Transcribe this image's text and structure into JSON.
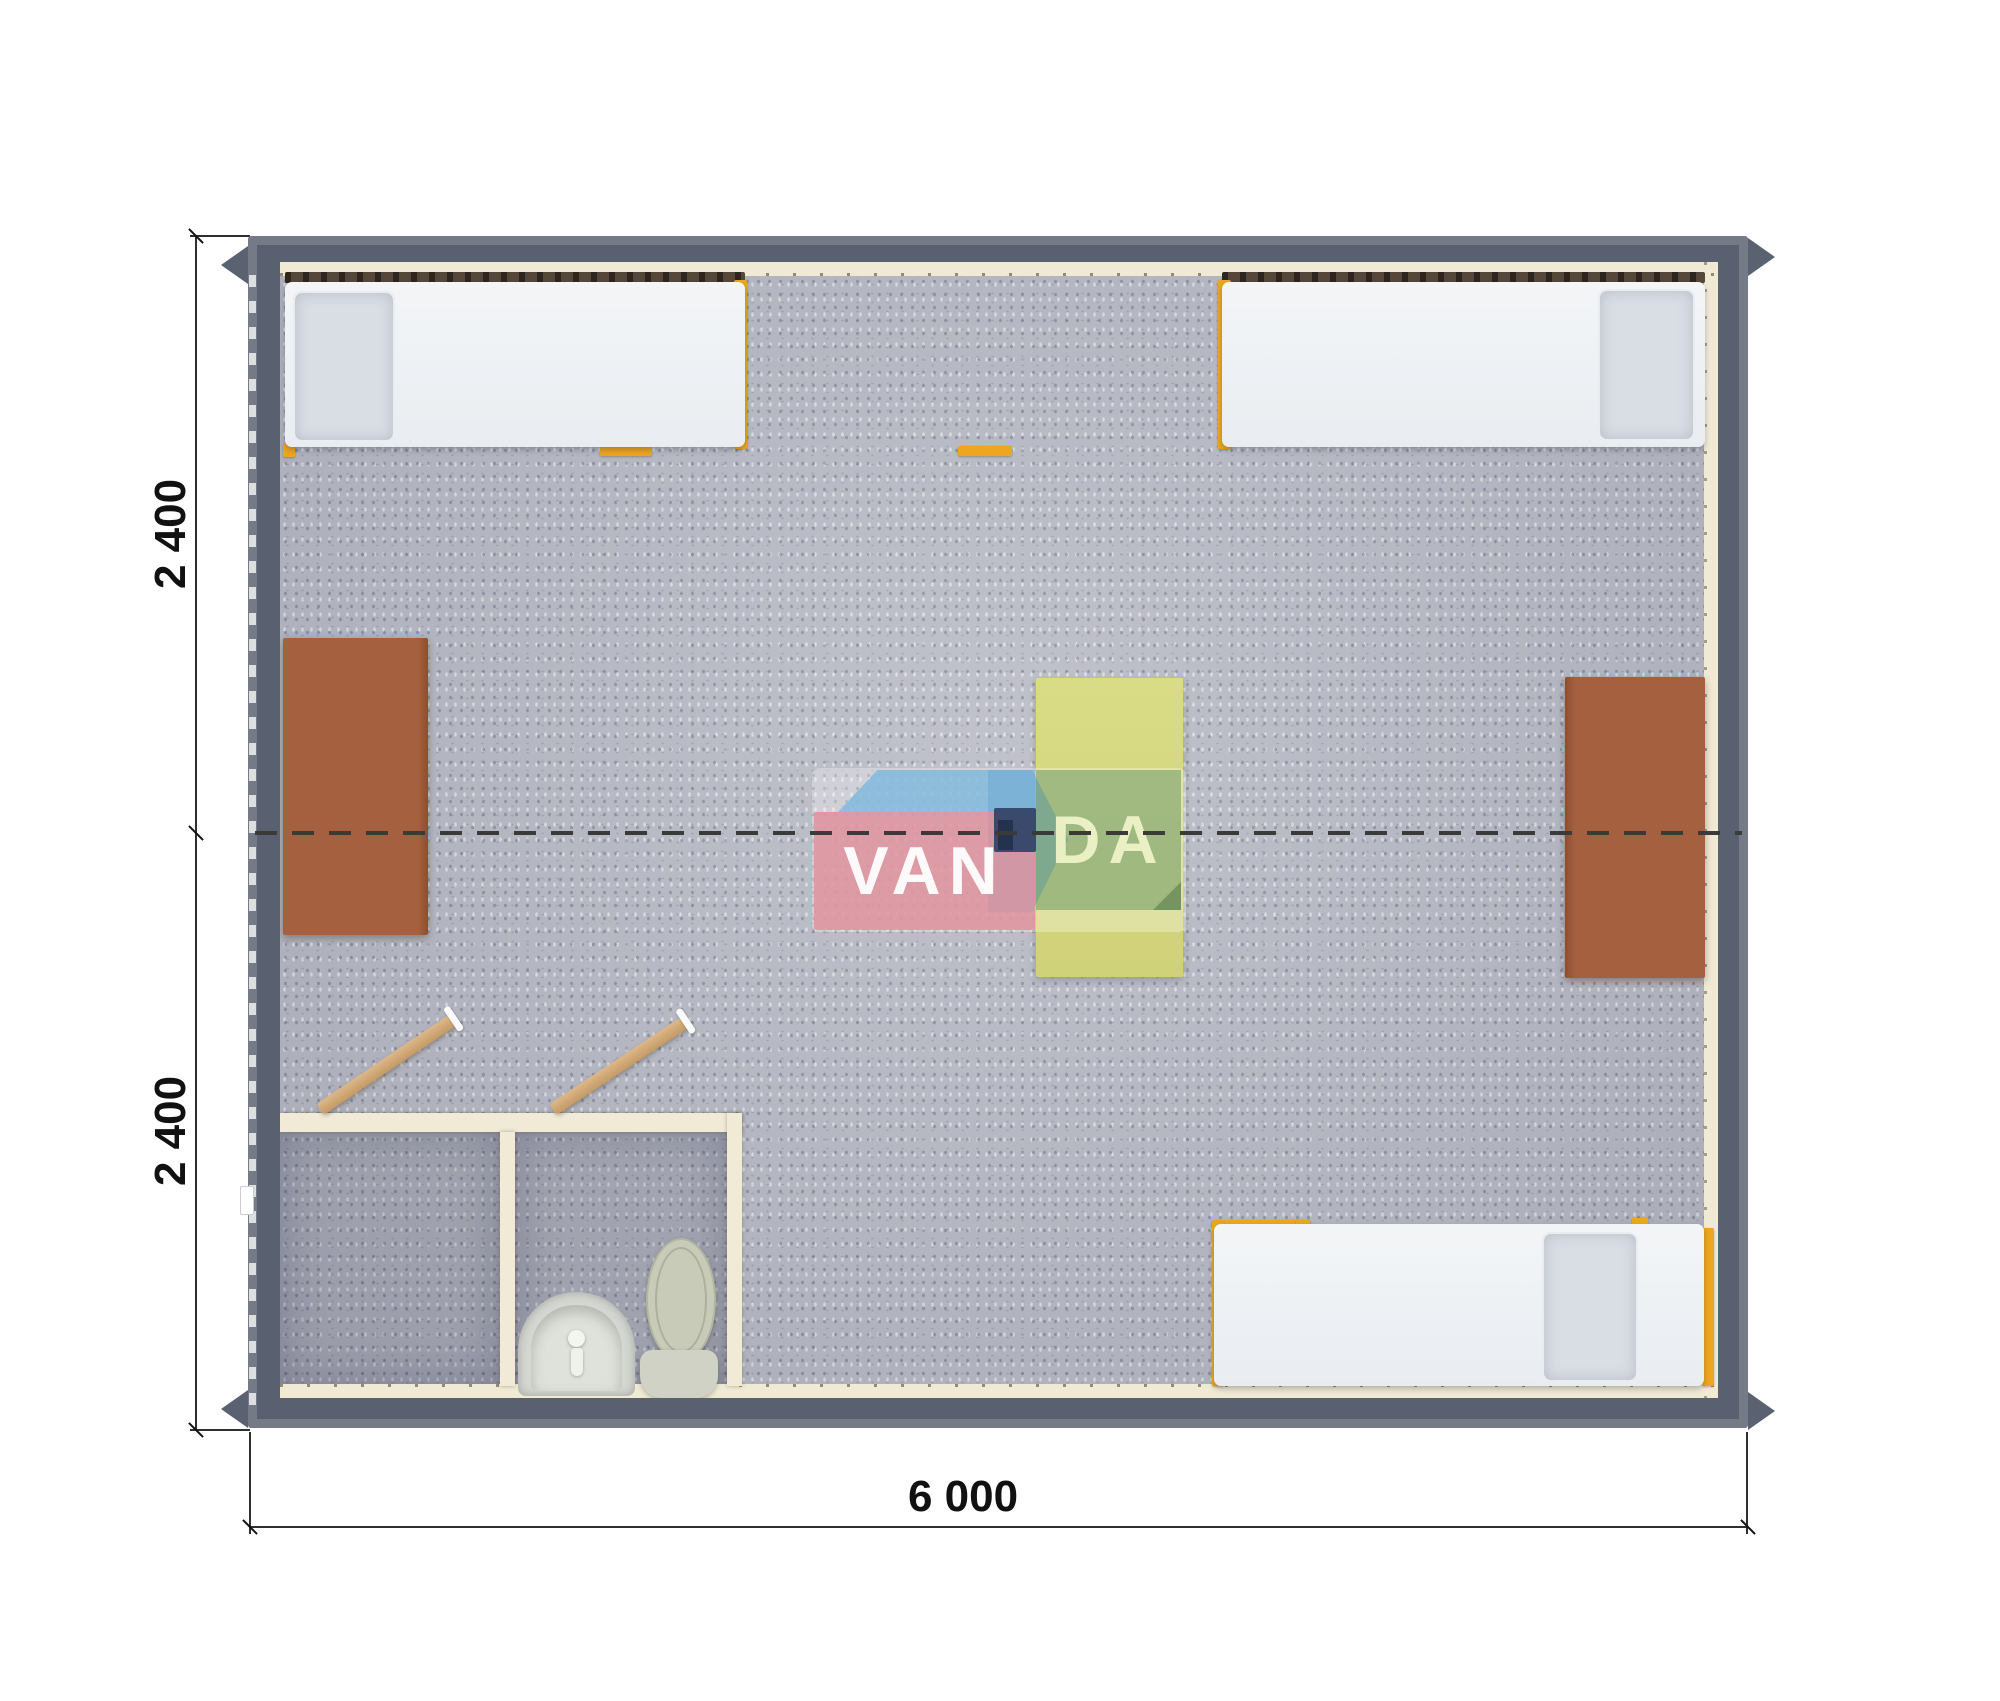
{
  "plan": {
    "title": "modular-cabin-floor-plan-top-view",
    "watermark": {
      "van": "VAN",
      "da": "DA"
    },
    "dimensions": {
      "left_top_label": "2 400",
      "left_bottom_label": "2 400",
      "bottom_label": "6 000"
    },
    "palette": {
      "wall": "#596070",
      "wall_rim": "#757b86",
      "floor": "#b6b8c3",
      "liner_cream": "#f0ead5",
      "bed_frame_orange": "#eda61f",
      "mattress": "#eef1f4",
      "pillow": "#d9dde4",
      "table_brown": "#a5613f",
      "table_yellow": "#d7d881",
      "fixture_gray": "#ced1c3",
      "door_wood": "#d2a975",
      "logo_pink": "#de929c",
      "logo_blue": "#82b9dc",
      "logo_navy": "#334668",
      "logo_green": "#749e68",
      "dimension_text": "#111111"
    },
    "furniture": [
      "single-bed-top-left",
      "single-bed-top-right",
      "single-bed-bottom-right",
      "desk-left",
      "desk-right",
      "table-center",
      "bathroom-shower-room",
      "bathroom-wc-room",
      "sink",
      "toilet",
      "door-shower",
      "door-wc"
    ]
  }
}
